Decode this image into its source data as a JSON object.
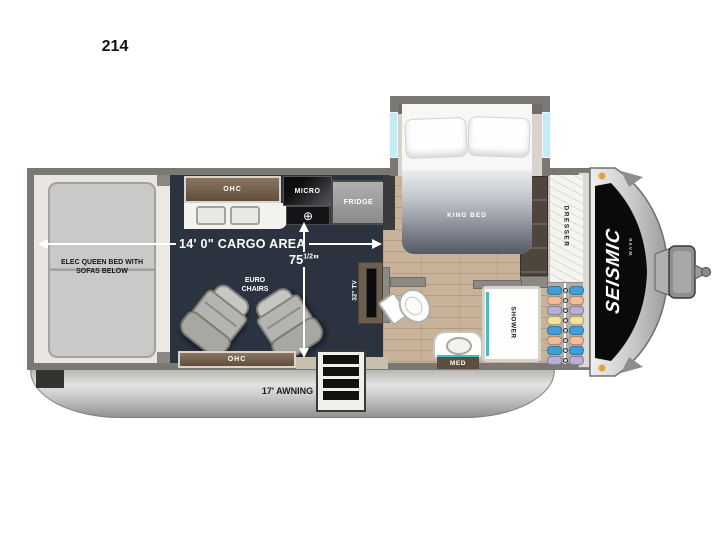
{
  "page": {
    "model_number": "214"
  },
  "floorplan": {
    "garage": {
      "bed_label": "ELEC QUEEN BED WITH SOFAS BELOW"
    },
    "kitchen": {
      "ohc": "OHC",
      "micro": "MICRO",
      "fridge": "FRIDGE",
      "burner": "⊕"
    },
    "measurements": {
      "cargo_length": "14' 0\" CARGO AREA",
      "width_whole": "75",
      "width_frac": "1/2",
      "width_unit": "\""
    },
    "living": {
      "chairs": "EURO CHAIRS",
      "ohc": "OHC",
      "tv": "32\" TV"
    },
    "bedroom": {
      "bed": "KING BED",
      "dresser": "DRESSER"
    },
    "bathroom": {
      "shower": "SHOWER",
      "med": "MED"
    },
    "exterior": {
      "awning": "17' AWNING",
      "brand": "SEISMIC",
      "brand_sub": "WAVE"
    },
    "wardrobe": {
      "clothes_colors": [
        "#3f9fd8",
        "#f2bc9a",
        "#b9aed6",
        "#f2e39a",
        "#3f9fd8",
        "#f2bc9a",
        "#3f9fd8",
        "#b9aed6"
      ]
    },
    "colors": {
      "cargo_floor": "#2c3340",
      "wood_floor": "#c8b39a",
      "accent_teal": "#3ac2c8",
      "cabinet_brown": "#6d5a48",
      "marker_orange": "#e59f3d"
    }
  }
}
